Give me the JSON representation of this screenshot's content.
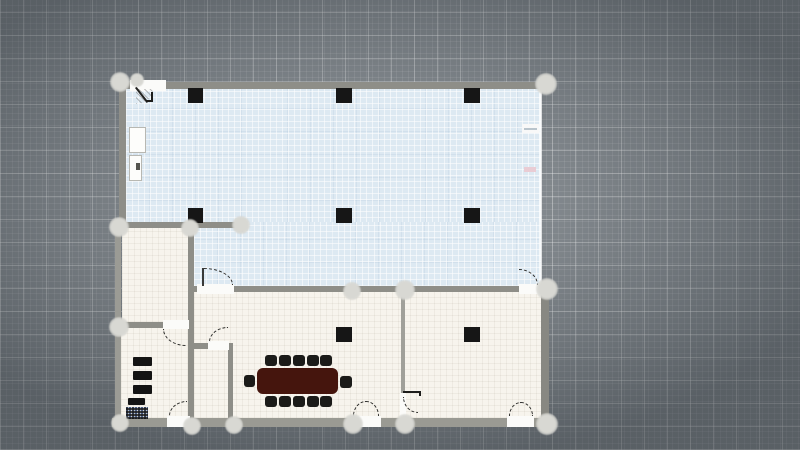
{
  "app": {
    "type": "floor-plan-editor-canvas",
    "visible_text": "none",
    "canvas_size": {
      "width": 800,
      "height": 450
    }
  },
  "palette": {
    "background": "#868c91",
    "grid_line_major": "rgba(255,255,255,0.30)",
    "grid_line_minor": "rgba(255,255,255,0.09)",
    "zone_blue": "#dde9f2",
    "room_cream": "#f7f4ed",
    "wall_gray": "#8e8e88",
    "column_black": "#161616",
    "table_brown": "#45150d",
    "chair_black": "#1b1b19",
    "handle_gray": "#d8d8d3",
    "door_arc": "#2e2e2c",
    "edge_tick_pink": "#e9ccd4"
  },
  "plan": {
    "fills": [
      {
        "name": "zone-open-office",
        "x": 126,
        "y": 88,
        "w": 415,
        "h": 136,
        "fill": "blue"
      },
      {
        "name": "zone-open-office-lower",
        "x": 194,
        "y": 222,
        "w": 347,
        "h": 64,
        "fill": "blue"
      },
      {
        "name": "room-upper-left",
        "x": 122,
        "y": 228,
        "w": 66,
        "h": 94,
        "fill": "cream"
      },
      {
        "name": "room-lower-left",
        "x": 121,
        "y": 328,
        "w": 67,
        "h": 90,
        "fill": "cream"
      },
      {
        "name": "rooms-bottom-band",
        "x": 194,
        "y": 292,
        "w": 347,
        "h": 126,
        "fill": "cream"
      }
    ],
    "walls": [
      {
        "name": "wall-top",
        "x": 122,
        "y": 82,
        "w": 419,
        "h": 7
      },
      {
        "name": "wall-left-upper",
        "x": 119,
        "y": 82,
        "w": 7,
        "h": 146
      },
      {
        "name": "wall-left-lower",
        "x": 115,
        "y": 226,
        "w": 6,
        "h": 194,
        "color": "#9b9b95"
      },
      {
        "name": "wall-bottom",
        "x": 112,
        "y": 418,
        "w": 437,
        "h": 9,
        "color": "#9a9a93"
      },
      {
        "name": "wall-right",
        "x": 541,
        "y": 290,
        "w": 8,
        "h": 128,
        "color": "#888882"
      },
      {
        "name": "wall-divider-a",
        "x": 119,
        "y": 222,
        "w": 118,
        "h": 6
      },
      {
        "name": "wall-divider-b",
        "x": 188,
        "y": 222,
        "w": 6,
        "h": 196
      },
      {
        "name": "wall-c-stub",
        "x": 194,
        "y": 286,
        "w": 4,
        "h": 6
      },
      {
        "name": "wall-c-main",
        "x": 233,
        "y": 286,
        "w": 288,
        "h": 6
      },
      {
        "name": "wall-divider-d",
        "x": 119,
        "y": 322,
        "w": 45,
        "h": 6
      },
      {
        "name": "wall-closet-top",
        "x": 194,
        "y": 343,
        "w": 15,
        "h": 6
      },
      {
        "name": "wall-closet-side",
        "x": 228,
        "y": 343,
        "w": 5,
        "h": 75
      },
      {
        "name": "wall-divider-e",
        "x": 401,
        "y": 292,
        "w": 4,
        "h": 101,
        "color": "#a0a09a"
      }
    ],
    "openings": [
      {
        "name": "door-top-left-opening",
        "x": 130,
        "y": 80,
        "w": 36,
        "h": 11
      },
      {
        "name": "door-c1-opening",
        "x": 197,
        "y": 284,
        "w": 37,
        "h": 10
      },
      {
        "name": "door-c2-opening",
        "x": 519,
        "y": 284,
        "w": 23,
        "h": 10
      },
      {
        "name": "door-d-opening",
        "x": 163,
        "y": 320,
        "w": 26,
        "h": 9
      },
      {
        "name": "door-closet-opening",
        "x": 208,
        "y": 341,
        "w": 21,
        "h": 9
      },
      {
        "name": "door-bottom-left-opening",
        "x": 167,
        "y": 416,
        "w": 23,
        "h": 11
      },
      {
        "name": "door-bottom-mid-opening",
        "x": 351,
        "y": 416,
        "w": 30,
        "h": 11
      },
      {
        "name": "door-bottom-right-opening",
        "x": 507,
        "y": 416,
        "w": 27,
        "h": 11
      },
      {
        "name": "door-e-opening",
        "x": 400,
        "y": 393,
        "w": 6,
        "h": 25
      }
    ],
    "columns": [
      {
        "name": "column",
        "x": 188,
        "y": 88,
        "w": 15,
        "h": 15
      },
      {
        "name": "column",
        "x": 336,
        "y": 88,
        "w": 16,
        "h": 15
      },
      {
        "name": "column",
        "x": 464,
        "y": 88,
        "w": 16,
        "h": 15
      },
      {
        "name": "column",
        "x": 188,
        "y": 208,
        "w": 15,
        "h": 15
      },
      {
        "name": "column",
        "x": 336,
        "y": 208,
        "w": 16,
        "h": 15
      },
      {
        "name": "column",
        "x": 464,
        "y": 208,
        "w": 16,
        "h": 15
      },
      {
        "name": "column",
        "x": 336,
        "y": 327,
        "w": 16,
        "h": 15
      },
      {
        "name": "column",
        "x": 464,
        "y": 327,
        "w": 16,
        "h": 15
      }
    ],
    "furniture": {
      "conference_table": {
        "name": "conference-table",
        "x": 257,
        "y": 368,
        "w": 81,
        "h": 26,
        "color": "#45150d",
        "radius": 6
      },
      "chairs": [
        {
          "name": "chair",
          "x": 265,
          "y": 355,
          "w": 12,
          "h": 11
        },
        {
          "name": "chair",
          "x": 279,
          "y": 355,
          "w": 12,
          "h": 11
        },
        {
          "name": "chair",
          "x": 293,
          "y": 355,
          "w": 12,
          "h": 11
        },
        {
          "name": "chair",
          "x": 307,
          "y": 355,
          "w": 12,
          "h": 11
        },
        {
          "name": "chair",
          "x": 320,
          "y": 355,
          "w": 12,
          "h": 11
        },
        {
          "name": "chair",
          "x": 265,
          "y": 396,
          "w": 12,
          "h": 11
        },
        {
          "name": "chair",
          "x": 279,
          "y": 396,
          "w": 12,
          "h": 11
        },
        {
          "name": "chair",
          "x": 293,
          "y": 396,
          "w": 12,
          "h": 11
        },
        {
          "name": "chair",
          "x": 307,
          "y": 396,
          "w": 12,
          "h": 11
        },
        {
          "name": "chair",
          "x": 320,
          "y": 396,
          "w": 12,
          "h": 11
        },
        {
          "name": "chair",
          "x": 244,
          "y": 375,
          "w": 11,
          "h": 12
        },
        {
          "name": "chair",
          "x": 340,
          "y": 376,
          "w": 12,
          "h": 12
        }
      ],
      "cabinets": [
        {
          "name": "cabinet",
          "x": 129,
          "y": 127,
          "w": 17,
          "h": 26
        },
        {
          "name": "cabinet",
          "x": 129,
          "y": 155,
          "w": 13,
          "h": 26
        }
      ],
      "cabinet_dot": {
        "name": "cabinet-mark",
        "x": 136,
        "y": 163,
        "w": 4,
        "h": 7,
        "color": "#55554f"
      },
      "shelves": [
        {
          "name": "shelf",
          "x": 133,
          "y": 357,
          "w": 19,
          "h": 9
        },
        {
          "name": "shelf",
          "x": 133,
          "y": 371,
          "w": 19,
          "h": 9
        },
        {
          "name": "shelf",
          "x": 133,
          "y": 385,
          "w": 19,
          "h": 9
        },
        {
          "name": "shelf-bar",
          "x": 128,
          "y": 398,
          "w": 17,
          "h": 7
        }
      ],
      "pixel_cluster": {
        "name": "small-fixture-cluster",
        "x": 126,
        "y": 407,
        "w": 22,
        "h": 12
      }
    },
    "marks": [
      {
        "name": "blue-edge-strip",
        "x": 539,
        "y": 88,
        "w": 3,
        "h": 198,
        "color": "rgba(255,255,255,0.75)"
      },
      {
        "name": "edge-notch-white",
        "x": 522,
        "y": 124,
        "w": 17,
        "h": 9,
        "color": "#f8f8f8"
      },
      {
        "name": "edge-notch-line",
        "x": 524,
        "y": 128,
        "w": 13,
        "h": 2,
        "color": "#b9c4cc"
      },
      {
        "name": "edge-tick-pink",
        "x": 524,
        "y": 167,
        "w": 12,
        "h": 5,
        "color": "#e9ccd4"
      },
      {
        "name": "door-c1-jamb-line",
        "x": 202,
        "y": 268,
        "w": 2,
        "h": 18,
        "color": "#3a3a38"
      }
    ],
    "door_arcs": [
      {
        "name": "door-arc",
        "x": 204,
        "y": 268,
        "w": 29,
        "h": 17,
        "corner": "tr",
        "style": "dashed"
      },
      {
        "name": "door-arc",
        "x": 519,
        "y": 269,
        "w": 19,
        "h": 16,
        "corner": "tr",
        "style": "dashed"
      },
      {
        "name": "door-arc",
        "x": 163,
        "y": 329,
        "w": 23,
        "h": 17,
        "corner": "bl",
        "style": "dashed"
      },
      {
        "name": "door-arc",
        "x": 209,
        "y": 327,
        "w": 19,
        "h": 15,
        "corner": "tl",
        "style": "dashed"
      },
      {
        "name": "door-arc",
        "x": 169,
        "y": 401,
        "w": 18,
        "h": 15,
        "corner": "tl",
        "style": "dashed"
      },
      {
        "name": "door-arc",
        "x": 353,
        "y": 401,
        "w": 13,
        "h": 15,
        "corner": "tl",
        "style": "dashed"
      },
      {
        "name": "door-arc",
        "x": 366,
        "y": 401,
        "w": 13,
        "h": 15,
        "corner": "tr",
        "style": "dashed"
      },
      {
        "name": "door-arc",
        "x": 509,
        "y": 402,
        "w": 12,
        "h": 14,
        "corner": "tl",
        "style": "dashed"
      },
      {
        "name": "door-arc",
        "x": 521,
        "y": 402,
        "w": 12,
        "h": 14,
        "corner": "tr",
        "style": "dashed"
      },
      {
        "name": "door-arc",
        "x": 403,
        "y": 397,
        "w": 15,
        "h": 16,
        "corner": "bl",
        "style": "dashed"
      }
    ],
    "door_details": [
      {
        "name": "door-swing-hatch",
        "kind": "hatch",
        "x": 136,
        "y": 89,
        "w": 17,
        "h": 15,
        "corner": "br"
      },
      {
        "name": "door-leaf",
        "kind": "leaf",
        "x": 135,
        "y": 88,
        "w": 2,
        "h": 19,
        "rotate": -38
      },
      {
        "name": "door-jamb",
        "kind": "jamb",
        "x": 146,
        "y": 92,
        "w": 7,
        "h": 10,
        "borders": [
          "right",
          "bottom"
        ]
      },
      {
        "name": "door-jamb",
        "kind": "jamb",
        "x": 403,
        "y": 391,
        "w": 18,
        "h": 5,
        "borders": [
          "top",
          "right"
        ]
      }
    ],
    "handles": [
      {
        "name": "selection-handle",
        "cx": 120,
        "cy": 82,
        "d": 20
      },
      {
        "name": "selection-handle",
        "cx": 137,
        "cy": 80,
        "d": 14
      },
      {
        "name": "selection-handle",
        "cx": 546,
        "cy": 84,
        "d": 22
      },
      {
        "name": "selection-handle",
        "cx": 119,
        "cy": 227,
        "d": 20
      },
      {
        "name": "selection-handle",
        "cx": 190,
        "cy": 228,
        "d": 18
      },
      {
        "name": "selection-handle",
        "cx": 241,
        "cy": 225,
        "d": 18
      },
      {
        "name": "selection-handle",
        "cx": 119,
        "cy": 327,
        "d": 20
      },
      {
        "name": "selection-handle",
        "cx": 352,
        "cy": 291,
        "d": 18
      },
      {
        "name": "selection-handle",
        "cx": 405,
        "cy": 290,
        "d": 20
      },
      {
        "name": "selection-handle",
        "cx": 547,
        "cy": 289,
        "d": 22
      },
      {
        "name": "selection-handle",
        "cx": 120,
        "cy": 423,
        "d": 18
      },
      {
        "name": "selection-handle",
        "cx": 192,
        "cy": 426,
        "d": 18
      },
      {
        "name": "selection-handle",
        "cx": 234,
        "cy": 425,
        "d": 18
      },
      {
        "name": "selection-handle",
        "cx": 353,
        "cy": 424,
        "d": 20
      },
      {
        "name": "selection-handle",
        "cx": 405,
        "cy": 424,
        "d": 20
      },
      {
        "name": "selection-handle",
        "cx": 547,
        "cy": 424,
        "d": 22
      }
    ]
  }
}
